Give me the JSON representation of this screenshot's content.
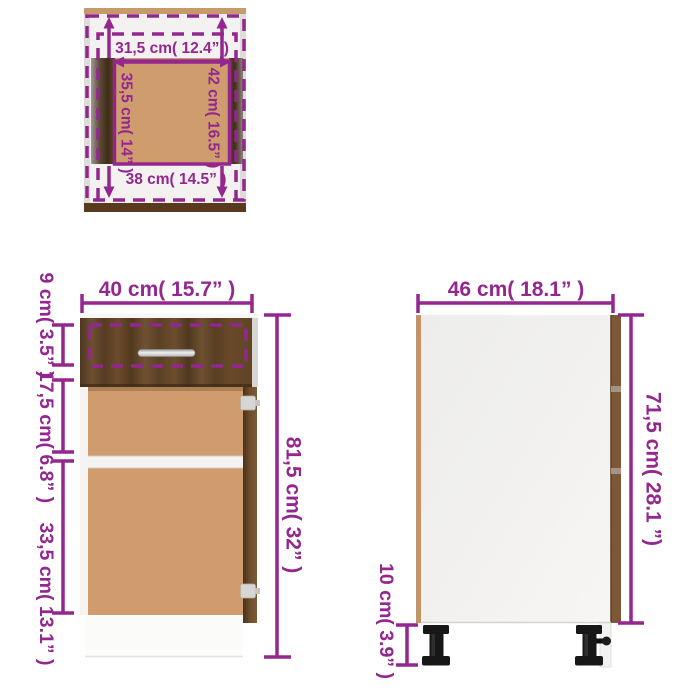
{
  "diagram": {
    "type": "furniture-dimension-diagram",
    "subject": "kitchen base cabinet with drawer and door",
    "top_view": {
      "inner_width": "31,5 cm( 12.4” )",
      "inner_depth": "35,5 cm( 14” )",
      "total_depth": "42 cm( 16.5” )",
      "bottom_width": "38 cm( 14.5” )"
    },
    "front_view": {
      "width": "40 cm( 15.7” )",
      "drawer_height": "9 cm( 3.5” )",
      "upper_height": "17,5 cm( 6.8” )",
      "lower_height": "33,5 cm( 13.1” )",
      "total_height": "81,5 cm( 32” )"
    },
    "side_view": {
      "depth": "46 cm( 18.1” )",
      "body_height": "71,5 cm( 28.1 ”)",
      "leg_height": "10 cm( 3.9” )"
    },
    "colors": {
      "dimension_magenta": "#93278F",
      "walnut_dark": "#5e4429",
      "hardboard_tan": "#d09c6e",
      "panel_white": "#f2f1ef",
      "leg_black": "#181818"
    }
  }
}
